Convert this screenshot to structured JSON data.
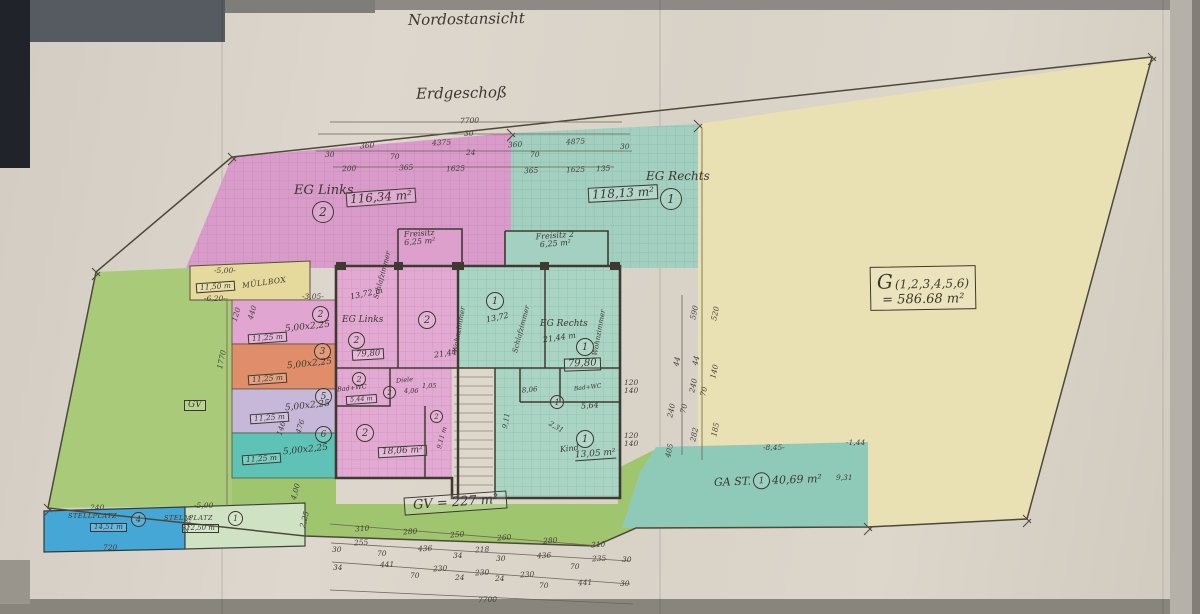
{
  "titles": {
    "view": "Nordostansicht",
    "floor": "Erdgeschoß"
  },
  "units": {
    "links": {
      "name": "EG Links",
      "no": "2",
      "area": "116,34 m²",
      "wohnflaeche": "79,80"
    },
    "rechts": {
      "name": "EG Rechts",
      "no": "1",
      "area": "118,13 m²",
      "wohnflaeche": "79,80"
    }
  },
  "plot": {
    "g": "G",
    "list": "(1,2,3,4,5,6)",
    "area": "= 586.68 m²"
  },
  "gv": {
    "tag": "GV",
    "label": "GV = 227 m²"
  },
  "ga": {
    "name": "GA ST.",
    "no": "1",
    "area": "40,69 m²"
  },
  "muellbox": {
    "name": "MÜLLBOX",
    "area": "11,50 m"
  },
  "freisitz1": {
    "name": "Freisitz",
    "area": "6,25 m²"
  },
  "freisitz2": {
    "name": "Freisitz 2",
    "area": "6,25 m²"
  },
  "stalls": [
    {
      "no": "2",
      "size": "5,00x2,25",
      "area": "11,25 m"
    },
    {
      "no": "3",
      "size": "5,00x2,25",
      "area": "11,25 m"
    },
    {
      "no": "5",
      "size": "5,00x2,25",
      "area": "11,25 m"
    },
    {
      "no": "6",
      "size": "5,00x2,25",
      "area": "11,25 m"
    }
  ],
  "parking": [
    {
      "name": "STELLPLATZ",
      "no": "4",
      "area": "14,51 m"
    },
    {
      "name": "STELLPLATZ",
      "no": "1",
      "area": "12,50 m"
    }
  ],
  "rooms": {
    "l_unit": "EG Links",
    "l_no": "2",
    "l_area": "79,80",
    "l_schlaf": "Schlafzimmer",
    "l_schlaf_area": "13,72 m",
    "l_wohn": "Wohnzimmer",
    "l_wohn_area": "21,44",
    "l_wohn_no": "2",
    "l_bad": "Bad+WC",
    "l_bad_area": "5,44 m",
    "l_bad_no": "2",
    "l_diele": "Diele",
    "l_diele_area": "4,06",
    "l_diele_extra": "1,05",
    "l_diele_no": "2",
    "l_kueche_area": "18,06 m²",
    "l_kueche_no": "2",
    "l_nische_area": "9,11 m",
    "l_nische_no": "2",
    "r_unit": "EG Rechts",
    "r_no": "1",
    "r_area": "79,80",
    "r_schlaf": "Schlafzimmer",
    "r_schlaf_area": "13,72",
    "r_schlaf_no": "1",
    "r_wohn": "Wohnzimmer",
    "r_wohn_area": "21,44 m",
    "r_wohn_no": "1",
    "r_diele_area": "8,06",
    "r_diele_no": "1",
    "r_bad": "Bad+WC",
    "r_bad_area": "5,64",
    "r_kind": "Kind",
    "r_kind_area": "13,05 m²",
    "r_kind_no": "1",
    "r_nische_area": "9,11",
    "stair_note": "2,31"
  },
  "annotations": [
    {
      "t": "7700",
      "x": 460,
      "y": 116,
      "r": -2
    },
    {
      "t": "30",
      "x": 464,
      "y": 129
    },
    {
      "t": "30",
      "x": 325,
      "y": 150
    },
    {
      "t": "360",
      "x": 360,
      "y": 141,
      "r": -3
    },
    {
      "t": "70",
      "x": 390,
      "y": 152
    },
    {
      "t": "4375",
      "x": 432,
      "y": 138,
      "r": -3
    },
    {
      "t": "24",
      "x": 466,
      "y": 148
    },
    {
      "t": "360",
      "x": 508,
      "y": 140,
      "r": -3
    },
    {
      "t": "70",
      "x": 530,
      "y": 150
    },
    {
      "t": "4875",
      "x": 566,
      "y": 137,
      "r": -3
    },
    {
      "t": "30",
      "x": 620,
      "y": 142
    },
    {
      "t": "200",
      "x": 342,
      "y": 164,
      "r": -2
    },
    {
      "t": "365",
      "x": 399,
      "y": 163,
      "r": -2
    },
    {
      "t": "1625",
      "x": 446,
      "y": 164,
      "r": -2
    },
    {
      "t": "365",
      "x": 524,
      "y": 166,
      "r": -2
    },
    {
      "t": "1625",
      "x": 566,
      "y": 165,
      "r": -2
    },
    {
      "t": "135",
      "x": 596,
      "y": 164,
      "r": -2
    },
    {
      "t": "310",
      "x": 355,
      "y": 524,
      "r": -4
    },
    {
      "t": "280",
      "x": 403,
      "y": 527,
      "r": -4
    },
    {
      "t": "250",
      "x": 450,
      "y": 530,
      "r": -4
    },
    {
      "t": "260",
      "x": 497,
      "y": 533,
      "r": -4
    },
    {
      "t": "280",
      "x": 543,
      "y": 536,
      "r": -4
    },
    {
      "t": "310",
      "x": 591,
      "y": 540,
      "r": -4
    },
    {
      "t": "30",
      "x": 332,
      "y": 545
    },
    {
      "t": "255",
      "x": 354,
      "y": 538,
      "r": -3
    },
    {
      "t": "70",
      "x": 377,
      "y": 549
    },
    {
      "t": "436",
      "x": 418,
      "y": 544,
      "r": -3
    },
    {
      "t": "34",
      "x": 453,
      "y": 551
    },
    {
      "t": "218",
      "x": 475,
      "y": 545,
      "r": -3
    },
    {
      "t": "30",
      "x": 496,
      "y": 554
    },
    {
      "t": "436",
      "x": 537,
      "y": 551,
      "r": -3
    },
    {
      "t": "70",
      "x": 570,
      "y": 562
    },
    {
      "t": "235",
      "x": 592,
      "y": 554,
      "r": -3
    },
    {
      "t": "30",
      "x": 622,
      "y": 555
    },
    {
      "t": "34",
      "x": 333,
      "y": 563
    },
    {
      "t": "441",
      "x": 380,
      "y": 560,
      "r": -3
    },
    {
      "t": "70",
      "x": 410,
      "y": 571
    },
    {
      "t": "230",
      "x": 433,
      "y": 564,
      "r": -3
    },
    {
      "t": "24",
      "x": 455,
      "y": 573
    },
    {
      "t": "230",
      "x": 475,
      "y": 568,
      "r": -3
    },
    {
      "t": "24",
      "x": 495,
      "y": 574
    },
    {
      "t": "230",
      "x": 520,
      "y": 570,
      "r": -3
    },
    {
      "t": "70",
      "x": 539,
      "y": 581
    },
    {
      "t": "441",
      "x": 578,
      "y": 578,
      "r": -3
    },
    {
      "t": "30",
      "x": 620,
      "y": 579
    },
    {
      "t": "7700",
      "x": 478,
      "y": 595,
      "r": -2
    },
    {
      "t": "1770",
      "x": 212,
      "y": 355,
      "r": -78
    },
    {
      "t": "120",
      "x": 229,
      "y": 310,
      "r": -72
    },
    {
      "t": "440",
      "x": 245,
      "y": 308,
      "r": -72
    },
    {
      "t": "146",
      "x": 274,
      "y": 424,
      "r": -72
    },
    {
      "t": "476",
      "x": 293,
      "y": 422,
      "r": -72
    },
    {
      "t": "4,00",
      "x": 287,
      "y": 487,
      "r": -75
    },
    {
      "t": "590",
      "x": 687,
      "y": 308,
      "r": -78
    },
    {
      "t": "520",
      "x": 708,
      "y": 309,
      "r": -78
    },
    {
      "t": "44",
      "x": 672,
      "y": 357,
      "r": -78
    },
    {
      "t": "44",
      "x": 691,
      "y": 356,
      "r": -78
    },
    {
      "t": "140",
      "x": 707,
      "y": 367,
      "r": -78
    },
    {
      "t": "240",
      "x": 686,
      "y": 381,
      "r": -78
    },
    {
      "t": "70",
      "x": 699,
      "y": 387,
      "r": -78
    },
    {
      "t": "240",
      "x": 664,
      "y": 406,
      "r": -78
    },
    {
      "t": "70",
      "x": 679,
      "y": 404,
      "r": -78
    },
    {
      "t": "282",
      "x": 687,
      "y": 430,
      "r": -78
    },
    {
      "t": "185",
      "x": 708,
      "y": 425,
      "r": -78
    },
    {
      "t": "405",
      "x": 662,
      "y": 446,
      "r": -78
    },
    {
      "t": "120",
      "x": 624,
      "y": 378
    },
    {
      "t": "140",
      "x": 624,
      "y": 386
    },
    {
      "t": "120",
      "x": 624,
      "y": 431
    },
    {
      "t": "140",
      "x": 624,
      "y": 439
    },
    {
      "t": "-8,45-",
      "x": 763,
      "y": 443
    },
    {
      "t": "-1,44",
      "x": 846,
      "y": 438
    },
    {
      "t": "9,31",
      "x": 836,
      "y": 473
    },
    {
      "t": "-5,00-",
      "x": 214,
      "y": 266
    },
    {
      "t": "-6,20-",
      "x": 204,
      "y": 294
    },
    {
      "t": "-3,05-",
      "x": 302,
      "y": 292
    },
    {
      "t": "240",
      "x": 90,
      "y": 503
    },
    {
      "t": "720",
      "x": 103,
      "y": 543
    },
    {
      "t": "2,25",
      "x": 179,
      "y": 519,
      "r": -75
    },
    {
      "t": "-5,00",
      "x": 194,
      "y": 501
    },
    {
      "t": "2,25",
      "x": 296,
      "y": 515,
      "r": -75
    }
  ]
}
